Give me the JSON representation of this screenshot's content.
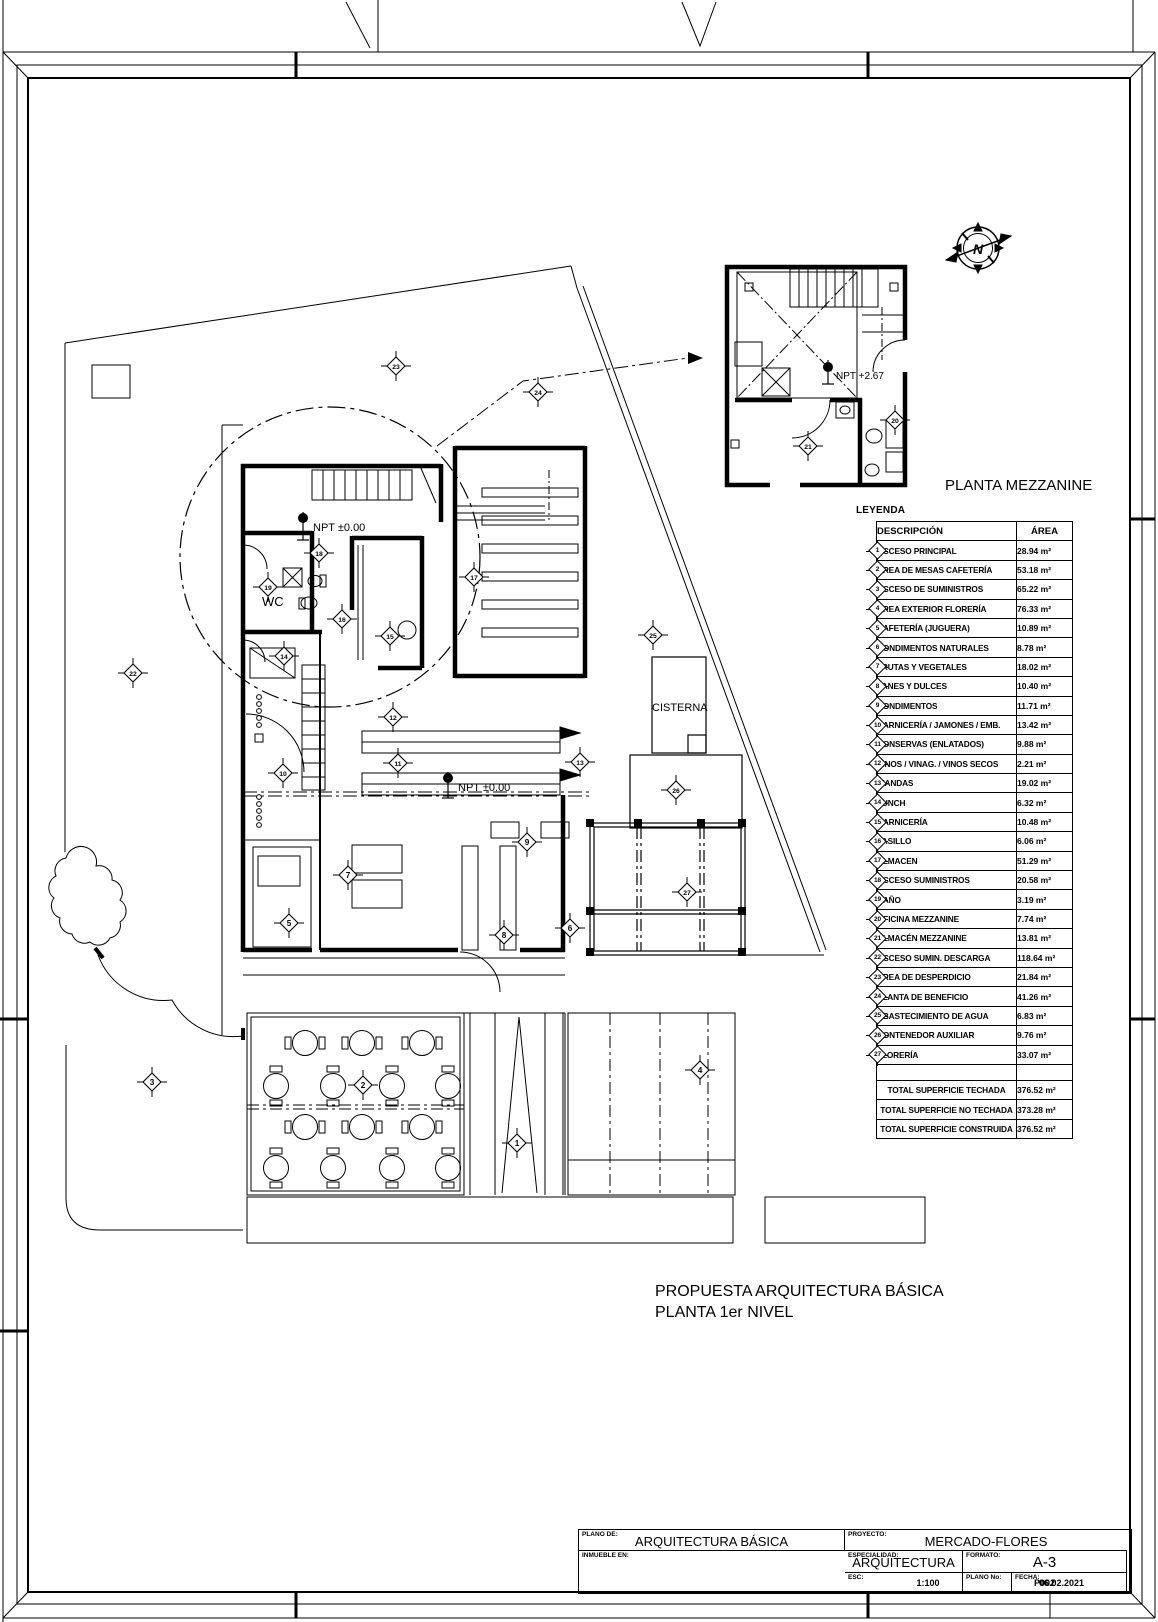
{
  "sheet": {
    "titles": {
      "mezzanine": "PLANTA MEZZANINE",
      "main_line1": "PROPUESTA ARQUITECTURA BÁSICA",
      "main_line2": "PLANTA 1er NIVEL"
    },
    "plan_labels": {
      "npt_ground_1": "NPT ±0.00",
      "npt_ground_2": "NPT ±0.00",
      "npt_mezzanine": "NPT +2.67",
      "wc": "WC",
      "cisterna": "CISTERNA",
      "north": "N"
    },
    "markers": {
      "plan": [
        {
          "n": 1,
          "x": 517,
          "y": 1143
        },
        {
          "n": 2,
          "x": 363,
          "y": 1085
        },
        {
          "n": 3,
          "x": 152,
          "y": 1082
        },
        {
          "n": 4,
          "x": 700,
          "y": 1070
        },
        {
          "n": 5,
          "x": 289,
          "y": 923
        },
        {
          "n": 6,
          "x": 570,
          "y": 928
        },
        {
          "n": 7,
          "x": 348,
          "y": 875
        },
        {
          "n": 8,
          "x": 504,
          "y": 935
        },
        {
          "n": 9,
          "x": 527,
          "y": 842
        },
        {
          "n": 10,
          "x": 283,
          "y": 773
        },
        {
          "n": 11,
          "x": 398,
          "y": 763
        },
        {
          "n": 12,
          "x": 393,
          "y": 717
        },
        {
          "n": 13,
          "x": 580,
          "y": 762
        },
        {
          "n": 14,
          "x": 284,
          "y": 656
        },
        {
          "n": 15,
          "x": 390,
          "y": 636
        },
        {
          "n": 16,
          "x": 342,
          "y": 619
        },
        {
          "n": 17,
          "x": 474,
          "y": 577
        },
        {
          "n": 18,
          "x": 319,
          "y": 553
        },
        {
          "n": 19,
          "x": 268,
          "y": 587
        },
        {
          "n": 22,
          "x": 133,
          "y": 673
        },
        {
          "n": 23,
          "x": 396,
          "y": 366
        },
        {
          "n": 24,
          "x": 538,
          "y": 392
        },
        {
          "n": 25,
          "x": 653,
          "y": 635
        },
        {
          "n": 26,
          "x": 676,
          "y": 790
        },
        {
          "n": 27,
          "x": 687,
          "y": 892
        }
      ],
      "mezzanine": [
        {
          "n": 20,
          "x": 895,
          "y": 420
        },
        {
          "n": 21,
          "x": 808,
          "y": 446
        }
      ]
    }
  },
  "legend": {
    "title": "LEYENDA",
    "columns": {
      "descripcion": "DESCRIPCIÓN",
      "area": "ÁREA"
    },
    "items": [
      {
        "id": 1,
        "label": "ACCESO PRINCIPAL",
        "area": "28.94 m²"
      },
      {
        "id": 2,
        "label": "ÁREA DE MESAS CAFETERÍA",
        "area": "53.18 m²"
      },
      {
        "id": 3,
        "label": "ACCESO DE SUMINISTROS",
        "area": "65.22 m²"
      },
      {
        "id": 4,
        "label": "ÁREA EXTERIOR FLORERÍA",
        "area": "76.33 m²"
      },
      {
        "id": 5,
        "label": "CAFETERÍA (JUGUERA)",
        "area": "10.89 m²"
      },
      {
        "id": 6,
        "label": "CONDIMENTOS NATURALES",
        "area": "8.78 m²"
      },
      {
        "id": 7,
        "label": "FRUTAS Y VEGETALES",
        "area": "18.02 m²"
      },
      {
        "id": 8,
        "label": "PANES Y DULCES",
        "area": "10.40 m²"
      },
      {
        "id": 9,
        "label": "CONDIMENTOS",
        "area": "11.71 m²"
      },
      {
        "id": 10,
        "label": "CARNICERÍA / JAMONES / EMB.",
        "area": "13.42 m²"
      },
      {
        "id": 11,
        "label": "CONSERVAS (ENLATADOS)",
        "area": "9.88 m²"
      },
      {
        "id": 12,
        "label": "VINOS / VINAG. / VINOS SECOS",
        "area": "2.21 m²"
      },
      {
        "id": 13,
        "label": "VIANDAS",
        "area": "19.02 m²"
      },
      {
        "id": 14,
        "label": "LUNCH",
        "area": "6.32 m²"
      },
      {
        "id": 15,
        "label": "CARNICERÍA",
        "area": "10.48 m²"
      },
      {
        "id": 16,
        "label": "PASILLO",
        "area": "6.06 m²"
      },
      {
        "id": 17,
        "label": "ALMACEN",
        "area": "51.29 m²"
      },
      {
        "id": 18,
        "label": "ACCESO SUMINISTROS",
        "area": "20.58 m²"
      },
      {
        "id": 19,
        "label": "BAÑO",
        "area": "3.19 m²"
      },
      {
        "id": 20,
        "label": "OFICINA MEZZANINE",
        "area": "7.74 m²"
      },
      {
        "id": 21,
        "label": "ALMACÉN MEZZANINE",
        "area": "13.81 m²"
      },
      {
        "id": 22,
        "label": "ACCESO SUMIN. DESCARGA",
        "area": "118.64 m²"
      },
      {
        "id": 23,
        "label": "ÁREA DE DESPERDICIO",
        "area": "21.84 m²"
      },
      {
        "id": 24,
        "label": "PLANTA DE BENEFICIO",
        "area": "41.26 m²"
      },
      {
        "id": 25,
        "label": "ABASTECIMIENTO DE AGUA",
        "area": "6.83 m²"
      },
      {
        "id": 26,
        "label": "CONTENEDOR AUXILIAR",
        "area": "9.76 m²"
      },
      {
        "id": 27,
        "label": "FLORERÍA",
        "area": "33.07 m²"
      }
    ],
    "totals": [
      {
        "label": "TOTAL  SUPERFICIE TECHADA",
        "area": "376.52 m²"
      },
      {
        "label": "TOTAL  SUPERFICIE NO TECHADA",
        "area": "373.28 m²"
      },
      {
        "label": "TOTAL  SUPERFICIE CONSTRUIDA",
        "area": "376.52 m²"
      }
    ]
  },
  "title_block": {
    "plano_de": {
      "label": "PLANO DE:",
      "value": "ARQUITECTURA BÁSICA"
    },
    "proyecto": {
      "label": "PROYECTO:",
      "value": "MERCADO-FLORES"
    },
    "especialidad": {
      "label": "ESPECIALIDAD:",
      "value": "ARQUITECTURA"
    },
    "formato": {
      "label": "FORMATO:",
      "value": "A-3"
    },
    "inmueble_en": {
      "label": "INMUEBLE EN:",
      "value": ""
    },
    "esc": {
      "label": "ESC:",
      "value": "1:100"
    },
    "fecha": {
      "label": "FECHA:",
      "value": "06.02.2021"
    },
    "plano_no": {
      "label": "PLANO No:",
      "value": "P002"
    }
  },
  "colors": {
    "ink": "#000000",
    "paper": "#ffffff"
  }
}
